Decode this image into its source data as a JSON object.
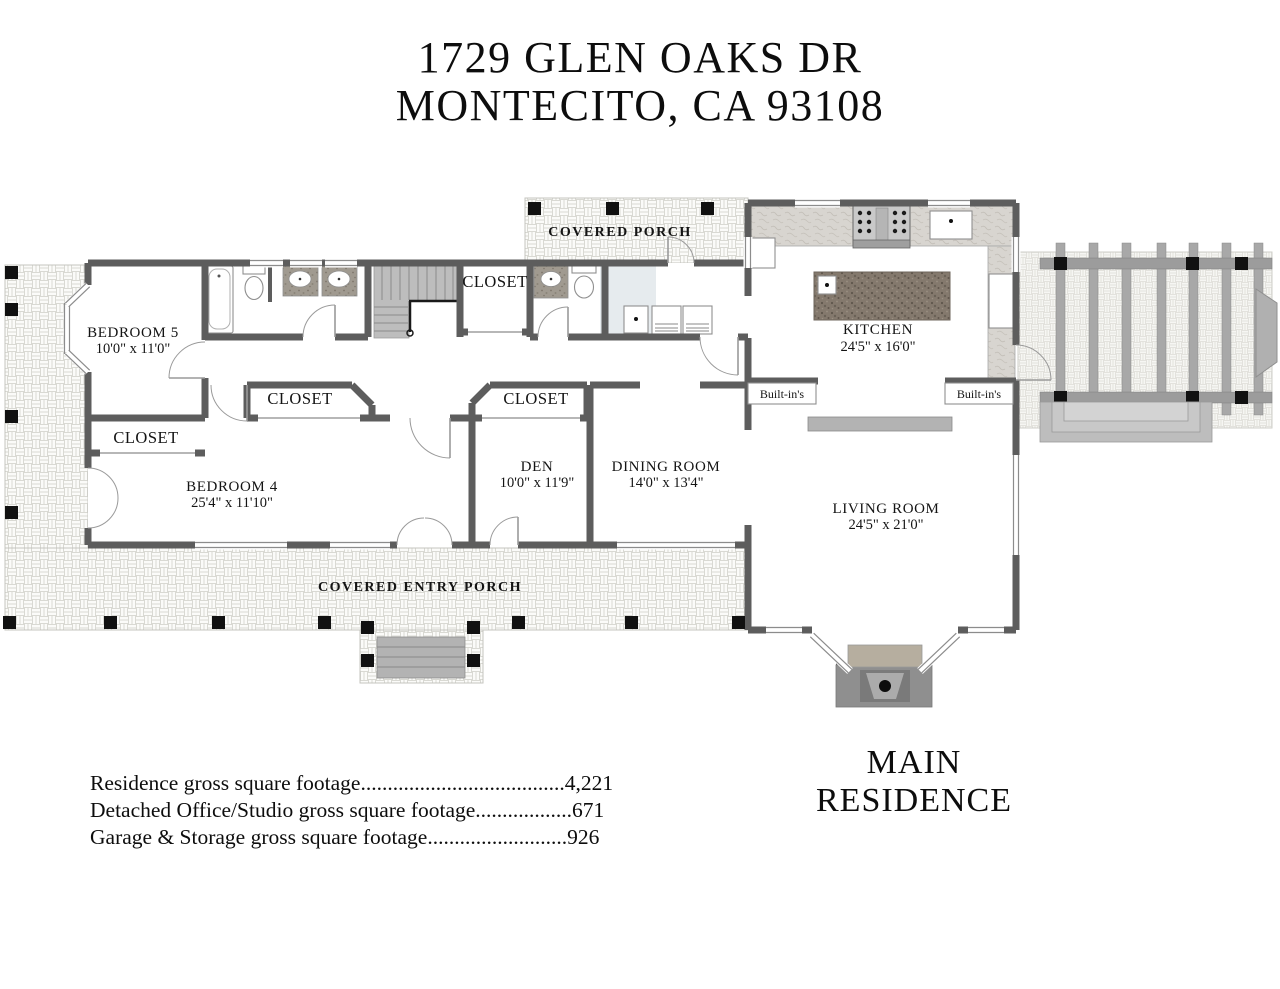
{
  "title": {
    "line1": "1729 GLEN OAKS DR",
    "line2": "MONTECITO, CA 93108"
  },
  "plan_title": "MAIN RESIDENCE",
  "rooms": {
    "bedroom5": {
      "name": "BEDROOM 5",
      "dims": "10'0\" x 11'0\""
    },
    "bedroom4": {
      "name": "BEDROOM 4",
      "dims": "25'4\" x 11'10\""
    },
    "den": {
      "name": "DEN",
      "dims": "10'0\" x 11'9\""
    },
    "dining_room": {
      "name": "DINING ROOM",
      "dims": "14'0\" x 13'4\""
    },
    "kitchen": {
      "name": "KITCHEN",
      "dims": "24'5\" x 16'0\""
    },
    "living_room": {
      "name": "LIVING ROOM",
      "dims": "24'5\" x 21'0\""
    }
  },
  "areas": {
    "covered_porch": "COVERED PORCH",
    "covered_entry_porch": "COVERED ENTRY PORCH",
    "closets": [
      "CLOSET",
      "CLOSET",
      "CLOSET",
      "CLOSET"
    ],
    "built_ins_left": "Built-in's",
    "built_ins_right": "Built-in's"
  },
  "footer": {
    "line1": "Residence gross square footage......................................4,221",
    "line2": "Detached Office/Studio gross square footage..................671",
    "line3": "Garage & Storage gross square footage..........................926"
  },
  "colors": {
    "wall": "#5d5d5d",
    "post": "#111111",
    "beam": "#9c9c9c",
    "tile_line": "#d9d9d3",
    "counter": "#d7d4cf",
    "island_granite": "#84796d",
    "stairs": "#bdbdbd",
    "fireplace_mantel": "#b6ae9f"
  }
}
